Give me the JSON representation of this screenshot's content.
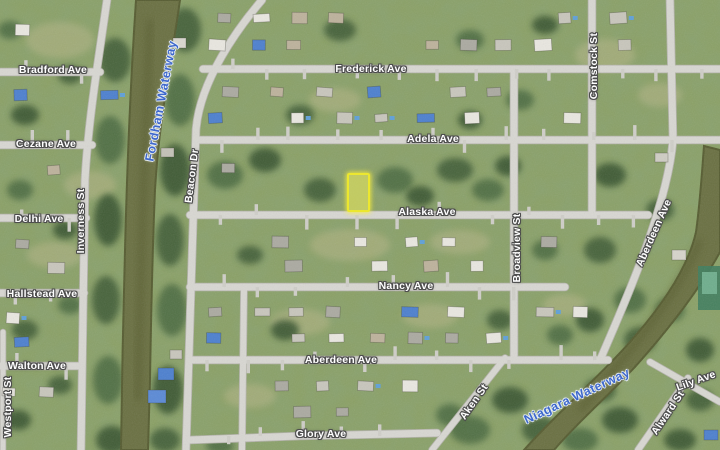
{
  "map": {
    "view": "satellite",
    "size": {
      "width": 720,
      "height": 450
    },
    "colors": {
      "grass": "#8ba064",
      "road": "#d8d7d2",
      "road_edge": "#b3b2aa",
      "driveway": "#cfcec8",
      "water": "#6a7042",
      "water_edge": "#565c31",
      "street_label": "#ffffff",
      "street_label_outline": "#4d4d4d",
      "waterway_label": "#3e68cc",
      "parcel_outline": "#ece72f",
      "parcel_fill": "rgba(248,243,90,0.5)"
    },
    "highlighted_parcel": {
      "x": 347,
      "y": 173,
      "width": 19,
      "height": 35
    },
    "labels": [
      {
        "id": "bradford-ave",
        "name": "Bradford Ave",
        "kind": "street",
        "x": 53,
        "y": 70,
        "rot": 0
      },
      {
        "id": "cezane-ave",
        "name": "Cezane Ave",
        "kind": "street",
        "x": 46,
        "y": 144,
        "rot": 0
      },
      {
        "id": "delhi-ave",
        "name": "Delhi Ave",
        "kind": "street",
        "x": 39,
        "y": 219,
        "rot": 0
      },
      {
        "id": "hallstead-ave",
        "name": "Hallstead Ave",
        "kind": "street",
        "x": 42,
        "y": 294,
        "rot": 0
      },
      {
        "id": "walton-ave",
        "name": "Walton Ave",
        "kind": "street",
        "x": 37,
        "y": 366,
        "rot": 0
      },
      {
        "id": "westport-st",
        "name": "Westport St",
        "kind": "street",
        "x": 8,
        "y": 407,
        "rot": -90
      },
      {
        "id": "inverness-st",
        "name": "Inverness St",
        "kind": "street",
        "x": 81,
        "y": 221,
        "rot": -90
      },
      {
        "id": "beacon-dr",
        "name": "Beacon Dr",
        "kind": "street",
        "x": 192,
        "y": 176,
        "rot": -83
      },
      {
        "id": "frederick-ave",
        "name": "Frederick Ave",
        "kind": "street",
        "x": 371,
        "y": 69,
        "rot": 0
      },
      {
        "id": "adela-ave",
        "name": "Adela Ave",
        "kind": "street",
        "x": 433,
        "y": 139,
        "rot": 0
      },
      {
        "id": "alaska-ave",
        "name": "Alaska Ave",
        "kind": "street",
        "x": 427,
        "y": 212,
        "rot": 0
      },
      {
        "id": "nancy-ave",
        "name": "Nancy Ave",
        "kind": "street",
        "x": 406,
        "y": 286,
        "rot": 0
      },
      {
        "id": "aberdeen-ave-h",
        "name": "Aberdeen Ave",
        "kind": "street",
        "x": 341,
        "y": 360,
        "rot": 0
      },
      {
        "id": "glory-ave",
        "name": "Glory Ave",
        "kind": "street",
        "x": 321,
        "y": 434,
        "rot": 0
      },
      {
        "id": "comstock-st",
        "name": "Comstock St",
        "kind": "street",
        "x": 594,
        "y": 66,
        "rot": -90
      },
      {
        "id": "broadview-st",
        "name": "Broadview St",
        "kind": "street",
        "x": 517,
        "y": 248,
        "rot": -90
      },
      {
        "id": "aberdeen-ave-d",
        "name": "Aberdeen Ave",
        "kind": "street",
        "x": 654,
        "y": 233,
        "rot": -66
      },
      {
        "id": "aken-st",
        "name": "Aken St",
        "kind": "street",
        "x": 474,
        "y": 402,
        "rot": -55
      },
      {
        "id": "alward-st",
        "name": "Alward St",
        "kind": "street",
        "x": 668,
        "y": 413,
        "rot": -56
      },
      {
        "id": "lily-ave",
        "name": "Lily Ave",
        "kind": "street",
        "x": 696,
        "y": 381,
        "rot": -20
      },
      {
        "id": "fordham-waterway",
        "name": "Fordham Waterway",
        "kind": "waterway",
        "x": 161,
        "y": 101,
        "rot": -79
      },
      {
        "id": "niagara-waterway",
        "name": "Niagara Waterway",
        "kind": "waterway",
        "x": 577,
        "y": 396,
        "rot": -25
      }
    ],
    "roads": [
      {
        "id": "bradford-ave",
        "d": "M0,72 L100,72",
        "w": 7
      },
      {
        "id": "cezane-ave",
        "d": "M0,145 L92,145",
        "w": 7
      },
      {
        "id": "delhi-ave",
        "d": "M0,218 L86,218",
        "w": 7
      },
      {
        "id": "hallstead-ave",
        "d": "M0,293 L84,293",
        "w": 7
      },
      {
        "id": "walton-ave",
        "d": "M0,366 L80,366",
        "w": 7
      },
      {
        "id": "westport-st",
        "d": "M3,332 L3,450",
        "w": 5
      },
      {
        "id": "inverness-st",
        "d": "M107,0 C100,50 88,120 85,180 L81,450",
        "w": 7
      },
      {
        "id": "beacon-dr",
        "d": "M262,0 C238,28 200,80 196,130 L186,450",
        "w": 7
      },
      {
        "id": "frederick-ave",
        "d": "M203,69 L720,69",
        "w": 7
      },
      {
        "id": "adela-ave",
        "d": "M199,140 L720,140",
        "w": 7
      },
      {
        "id": "alaska-ave",
        "d": "M190,215 L648,215",
        "w": 7
      },
      {
        "id": "nancy-ave",
        "d": "M190,287 L565,287",
        "w": 7
      },
      {
        "id": "aberdeen-ave-h",
        "d": "M190,360 L608,360",
        "w": 7
      },
      {
        "id": "glory-ave",
        "d": "M190,440 L300,436 L437,433",
        "w": 7
      },
      {
        "id": "comstock-st",
        "d": "M592,0 L592,215",
        "w": 7
      },
      {
        "id": "broadview-st",
        "d": "M514,69 L514,360",
        "w": 7
      },
      {
        "id": "aberdeen-ave-d",
        "d": "M670,0 L673,140 C668,200 635,280 600,360",
        "w": 7
      },
      {
        "id": "aken-st",
        "d": "M432,450 L505,358",
        "w": 6
      },
      {
        "id": "alward-st",
        "d": "M638,450 L688,378",
        "w": 6
      },
      {
        "id": "lily-ave",
        "d": "M650,362 L720,402",
        "w": 6
      },
      {
        "id": "midblock-st",
        "d": "M244,287 L242,450",
        "w": 6
      }
    ],
    "waterways": [
      {
        "id": "fordham-waterway",
        "d": "M136,0 L180,0 C170,70 159,120 155,190 C152,260 151,320 150,380 L148,450 L121,450 C122,380 123,320 125,250 C127,170 130,90 136,0 Z"
      },
      {
        "id": "niagara-waterway",
        "d": "M704,146 L720,150 L720,252 C698,292 668,330 634,368 C604,400 576,424 554,450 L524,450 C556,414 598,378 630,342 C662,306 688,268 696,232 C700,204 702,172 704,146 Z"
      }
    ]
  }
}
